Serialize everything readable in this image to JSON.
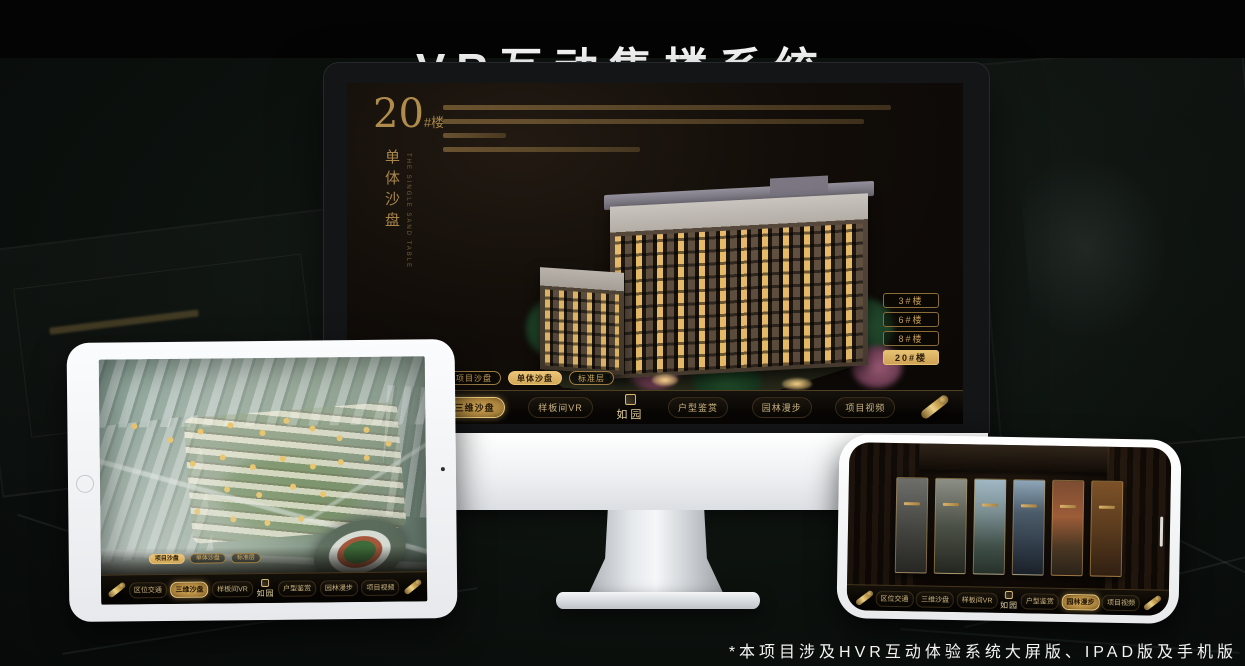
{
  "title": "VR互动售楼系统",
  "footnote": "*本项目涉及HVR互动体验系统大屏版、IPAD版及手机版",
  "logo": "如园",
  "nav_items": [
    "区位交通",
    "三维沙盘",
    "样板间VR",
    "户型鉴赏",
    "园林漫步",
    "项目视频"
  ],
  "sub_tabs": [
    "项目沙盘",
    "单体沙盘",
    "标准层"
  ],
  "monitor": {
    "heading_number": "20",
    "heading_suffix": "#楼",
    "heading_subtitle": "单体沙盘",
    "heading_subtitle_en": "THE SINGLE SAND TABLE",
    "building_buttons": [
      "3#楼",
      "6#楼",
      "8#楼",
      "20#楼"
    ],
    "active_building": "20#楼",
    "active_sub_tab": "单体沙盘",
    "active_nav": "三维沙盘"
  },
  "tablet": {
    "active_sub_tab": "项目沙盘",
    "active_nav": "三维沙盘"
  },
  "phone": {
    "active_nav": "园林漫步"
  },
  "colors": {
    "gold": "#d2a755",
    "gold_active": "#e3bb69",
    "screen_bg": "#14100b",
    "stage_bg": "#0b0f0d",
    "title_color": "#ffffff"
  }
}
